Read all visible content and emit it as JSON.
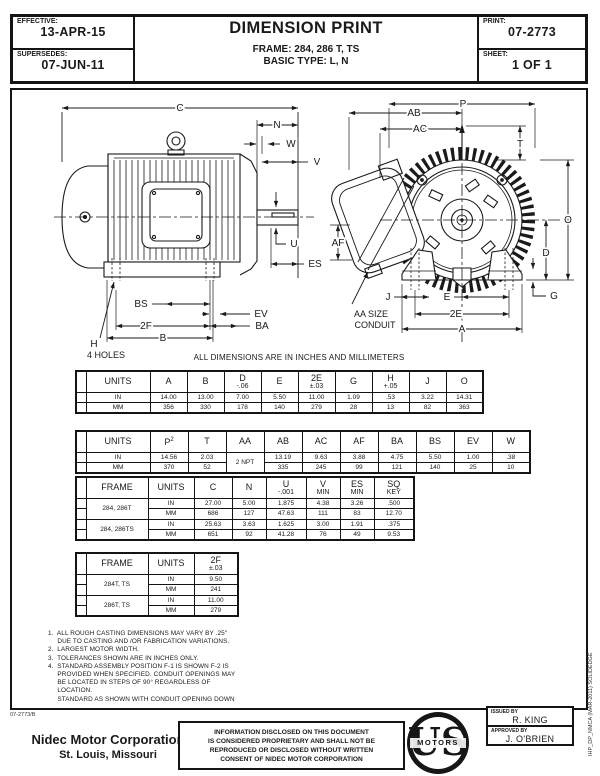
{
  "header": {
    "effective_label": "EFFECTIVE:",
    "effective_value": "13-APR-15",
    "supersedes_label": "SUPERSEDES:",
    "supersedes_value": "07-JUN-11",
    "title": "DIMENSION PRINT",
    "frame": "FRAME: 284, 286 T, TS",
    "basic_type": "BASIC TYPE: L, N",
    "print_label": "PRINT:",
    "print_value": "07-2773",
    "sheet_label": "SHEET:",
    "sheet_value": "1 OF 1"
  },
  "drawing": {
    "side": {
      "c": "C",
      "n": "N",
      "w": "W",
      "v": "V",
      "u": "U",
      "es": "ES",
      "bs": "BS",
      "ev": "EV",
      "ba": "BA",
      "f2": "2F",
      "b": "B",
      "h": "H",
      "holes": "4 HOLES"
    },
    "front": {
      "p": "P",
      "ab": "AB",
      "ac": "AC",
      "t": "T",
      "o": "O",
      "d": "D",
      "g": "G",
      "af": "AF",
      "j": "J",
      "e": "E",
      "e2": "2E",
      "a": "A",
      "aa1": "AA SIZE",
      "aa2": "CONDUIT"
    }
  },
  "units_note": "ALL DIMENSIONS ARE IN INCHES AND MILLIMETERS",
  "tables": [
    {
      "name": "dims-table-1",
      "widths": [
        10,
        64,
        37,
        37,
        37,
        37,
        37,
        37,
        37,
        37,
        37
      ],
      "headers": [
        {
          "t": ""
        },
        {
          "t": "UNITS"
        },
        {
          "t": "A"
        },
        {
          "t": "B"
        },
        {
          "t": "D",
          "s": "-.06"
        },
        {
          "t": "E"
        },
        {
          "t": "2E",
          "s": "±.03"
        },
        {
          "t": "G"
        },
        {
          "t": "H",
          "s": "+.05"
        },
        {
          "t": "J"
        },
        {
          "t": "O"
        }
      ],
      "rows": [
        [
          "",
          "IN",
          "14.00",
          "13.00",
          "7.00",
          "5.50",
          "11.00",
          "1.09",
          ".53",
          "3.22",
          "14.31"
        ],
        [
          "",
          "MM",
          "356",
          "330",
          "178",
          "140",
          "279",
          "28",
          "13",
          "82",
          "363"
        ]
      ]
    },
    {
      "name": "dims-table-2",
      "widths": [
        10,
        64,
        38,
        38,
        38,
        38,
        38,
        38,
        38,
        38,
        38,
        38
      ],
      "headers": [
        {
          "t": ""
        },
        {
          "t": "UNITS"
        },
        {
          "t": "P",
          "sup": "2"
        },
        {
          "t": "T"
        },
        {
          "t": "AA"
        },
        {
          "t": "AB"
        },
        {
          "t": "AC"
        },
        {
          "t": "AF"
        },
        {
          "t": "BA"
        },
        {
          "t": "BS"
        },
        {
          "t": "EV"
        },
        {
          "t": "W"
        }
      ],
      "rows": [
        [
          "",
          "IN",
          "14.56",
          "2.03",
          {
            "v": "2 NPT",
            "rs": 2
          },
          "13.19",
          "9.63",
          "3.88",
          "4.75",
          "5.50",
          "1.00",
          ".38"
        ],
        [
          "",
          "MM",
          "370",
          "52",
          null,
          "335",
          "245",
          "99",
          "121",
          "140",
          "25",
          "10"
        ]
      ]
    },
    {
      "name": "dims-table-frame",
      "widths": [
        10,
        62,
        46,
        38,
        34,
        40,
        34,
        34,
        40
      ],
      "headers": [
        {
          "t": ""
        },
        {
          "t": "FRAME"
        },
        {
          "t": "UNITS"
        },
        {
          "t": "C"
        },
        {
          "t": "N"
        },
        {
          "t": "U",
          "s": "-.001"
        },
        {
          "t": "V",
          "s": "MIN"
        },
        {
          "t": "ES",
          "s": "MIN"
        },
        {
          "t": "SQ",
          "s": "KEY"
        }
      ],
      "rows": [
        [
          "",
          {
            "v": "284, 286T",
            "rs": 2
          },
          "IN",
          "27.00",
          "5.00",
          "1.875",
          "4.38",
          "3.26",
          ".500"
        ],
        [
          "",
          null,
          "MM",
          "686",
          "127",
          "47.63",
          "111",
          "83",
          "12.70"
        ],
        [
          "",
          {
            "v": "284, 286TS",
            "rs": 2
          },
          "IN",
          "25.63",
          "3.63",
          "1.625",
          "3.00",
          "1.91",
          ".375"
        ],
        [
          "",
          null,
          "MM",
          "651",
          "92",
          "41.28",
          "76",
          "49",
          "9.53"
        ]
      ]
    },
    {
      "name": "dims-table-2f",
      "widths": [
        10,
        62,
        46,
        44
      ],
      "headers": [
        {
          "t": ""
        },
        {
          "t": "FRAME"
        },
        {
          "t": "UNITS"
        },
        {
          "t": "2F",
          "s": "±.03"
        }
      ],
      "rows": [
        [
          "",
          {
            "v": "284T, TS",
            "rs": 2
          },
          "IN",
          "9.50"
        ],
        [
          "",
          null,
          "MM",
          "241"
        ],
        [
          "",
          {
            "v": "286T, TS",
            "rs": 2
          },
          "IN",
          "11.00"
        ],
        [
          "",
          null,
          "MM",
          "279"
        ]
      ]
    }
  ],
  "notes": "1.  ALL ROUGH CASTING DIMENSIONS MAY VARY BY .25\"\n     DUE TO CASTING AND /OR FABRICATION VARIATIONS.\n2.  LARGEST MOTOR WIDTH.\n3.  TOLERANCES SHOWN ARE IN INCHES ONLY.\n4.  STANDARD ASSEMBLY POSITION F-1 IS SHOWN F-2 IS\n     PROVIDED WHEN SPECIFIED. CONDUIT OPENINGS MAY\n     BE LOCATED IN STEPS OF 90° REGARDLESS OF\n     LOCATION.\n     STANDARD AS SHOWN WITH CONDUIT OPENING DOWN",
  "footer": {
    "doc_code": "07-2773/B",
    "company_name": "Nidec Motor Corporation",
    "company_location": "St. Louis, Missouri",
    "disclosure": "INFORMATION DISCLOSED ON THIS DOCUMENT\nIS CONSIDERED PROPRIETARY AND SHALL NOT BE\nREPRODUCED OR DISCLOSED WITHOUT WRITTEN\nCONSENT OF NIDEC MOTOR CORPORATION",
    "logo_us": "US",
    "logo_motors": "MOTORS",
    "issued_by_label": "ISSUED BY",
    "issued_by": "R. KING",
    "approved_by_label": "APPROVED BY",
    "approved_by": "J. O'BRIEN",
    "side_code": "IHP_DP_NMCA (MAR-2011) SOLIDEDGE"
  }
}
